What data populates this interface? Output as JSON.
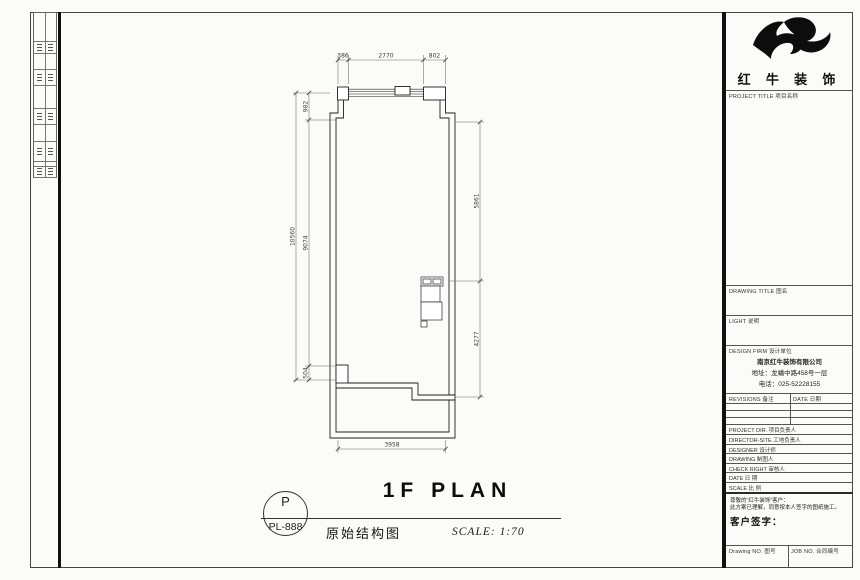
{
  "sheet": {
    "plan_title": "1F PLAN",
    "drawing_name": "原始结构图",
    "scale_note": "SCALE: 1:70",
    "stamp_letter": "P",
    "stamp_number": "PL-888"
  },
  "dimensions": {
    "top_segments": [
      "386",
      "2770",
      "802"
    ],
    "left_outer_total": "10560",
    "left_inner_segments": [
      "982",
      "9074",
      "504"
    ],
    "right_segments": [
      "5861",
      "4277"
    ],
    "bottom_total": "3958"
  },
  "title_block": {
    "brand": "红 牛 装 饰",
    "logo_name": "bull-logo",
    "project_title_label": "PROJECT TITLE 项目名称",
    "drawing_title_label": "DRAWING TITLE 图名",
    "light_label": "LIGHT 说明",
    "design_firm_label": "DESIGN FIRM 设计单位",
    "firm_name": "南京红牛装饰有限公司",
    "firm_address": "地址：龙蟠中路458号一层",
    "firm_phone": "电话：025-52228155",
    "revisions_label": "REVISIONS 备注",
    "date_col_label": "DATE 日期",
    "person_rows": [
      {
        "label": "PROJECT DIR.  项目负责人"
      },
      {
        "label": "DIRECTOR-SITE  工地负责人"
      },
      {
        "label": "DESIGNER  设计师"
      },
      {
        "label": "DRAWING  制图人"
      },
      {
        "label": "CHECK RIGHT  审核人"
      },
      {
        "label": "DATE  日 期"
      },
      {
        "label": "SCALE  比 例"
      }
    ],
    "client_note_line1": "尊敬的“红牛装饰”客户：",
    "client_note_line2": "此方案已理解，同意按本人签字的图纸施工。",
    "client_sign_label": "客户签字：",
    "drawing_no_label": "Drawing NO. 图号",
    "job_no_label": "JOB NO. 合同编号"
  }
}
